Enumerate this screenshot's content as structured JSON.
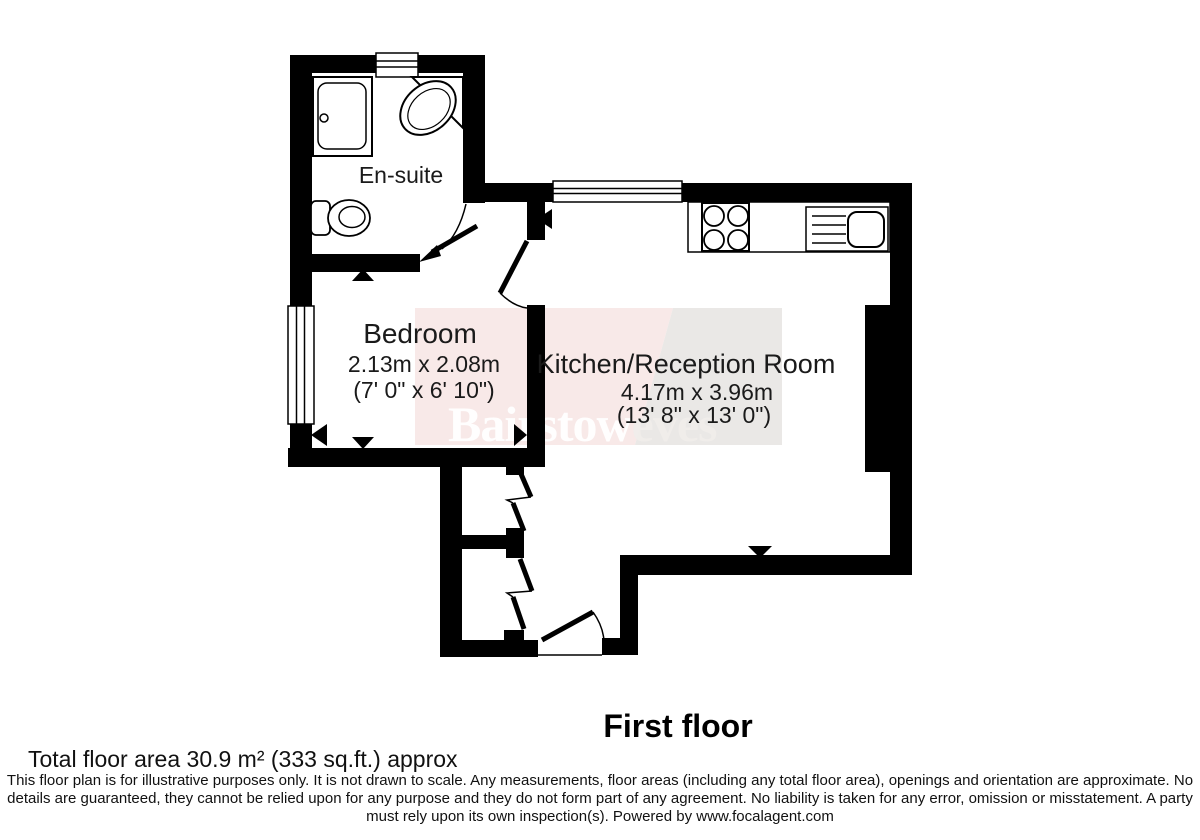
{
  "colors": {
    "background": "#ffffff",
    "wall": "#000000",
    "line": "#000000",
    "watermark_pink": "#f8e9e8",
    "watermark_gray": "#eae8e6",
    "watermark_text_left": "#ffffff",
    "watermark_text_right": "#f0edea"
  },
  "watermark": {
    "left": "Bairstow",
    "right": "eves"
  },
  "rooms": {
    "ensuite": {
      "name": "En-suite"
    },
    "bedroom": {
      "name": "Bedroom",
      "dims_metric": "2.13m x 2.08m",
      "dims_imperial": "(7' 0\" x 6' 10\")"
    },
    "kitchen": {
      "name": "Kitchen/Reception Room",
      "dims_metric": "4.17m x 3.96m",
      "dims_imperial": "(13' 8\" x 13' 0\")"
    }
  },
  "footer": {
    "floor_label": "First floor",
    "total_area": "Total floor area 30.9 m² (333 sq.ft.) approx",
    "disclaimer_lines": [
      "This floor plan is for illustrative purposes only. It is not drawn to scale. Any measurements, floor areas (including any total floor area), openings and orientation are approximate. No",
      "details are guaranteed, they cannot be relied upon for any purpose and they do not form part of any agreement. No liability is taken for any error, omission or misstatement. A party",
      "must rely upon its own inspection(s). Powered by www.focalagent.com"
    ]
  }
}
